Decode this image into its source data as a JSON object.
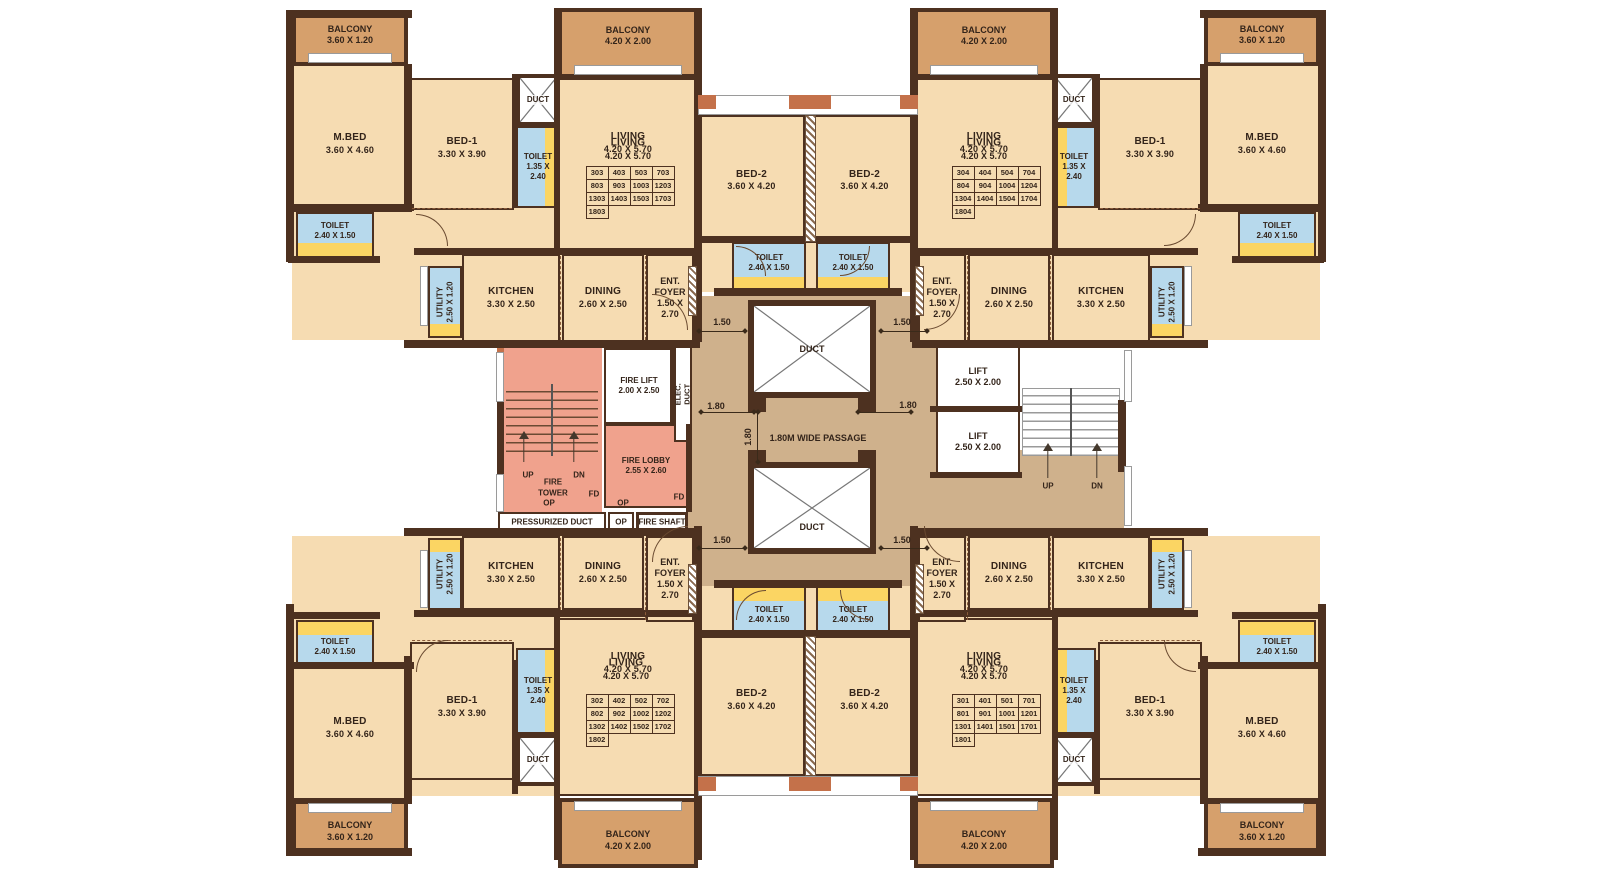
{
  "title": "Apartment typical floor plan",
  "colors": {
    "room_fill": "#f6dcb2",
    "balcony_fill": "#d6a06c",
    "wall": "#4d3120",
    "accent": "#c4714a",
    "toilet_blue": "#b7d9ec",
    "utility_yellow": "#fbd563",
    "fire_zone_pink": "#f0a28d",
    "passage_tan": "#cfb18c",
    "text": "#33241a"
  },
  "room_types": {
    "mbed": {
      "name": "M.BED",
      "dims": "3.60 X 4.60"
    },
    "bed1": {
      "name": "BED-1",
      "dims": "3.30 X 3.90"
    },
    "bed2": {
      "name": "BED-2",
      "dims": "3.60 X 4.20"
    },
    "living": {
      "name": "LIVING",
      "dims": "4.20 X 5.70"
    },
    "dining": {
      "name": "DINING",
      "dims": "2.60 X 2.50"
    },
    "kitchen": {
      "name": "KITCHEN",
      "dims": "3.30 X 2.50"
    },
    "balcony_mbed": {
      "name": "BALCONY",
      "dims": "3.60 X 1.20"
    },
    "balcony_living": {
      "name": "BALCONY",
      "dims": "4.20 X 2.00"
    },
    "toilet_240": {
      "name": "TOILET",
      "dims": "2.40 X 1.50"
    },
    "toilet_135": {
      "name": "TOILET",
      "dims": "1.35 X",
      "dims2": "2.40"
    },
    "utility": {
      "name": "UTILITY",
      "dims": "2.50 X 1.20"
    },
    "foyer": {
      "name": "ENT.",
      "name2": "FOYER",
      "dims": "1.50 X",
      "dims2": "2.70"
    },
    "duct": {
      "name": "DUCT"
    },
    "elec_duct": {
      "name": "ELEC. DUCT"
    },
    "fire_lift": {
      "name": "FIRE LIFT",
      "dims": "2.00 X 2.50"
    },
    "fire_lobby": {
      "name": "FIRE LOBBY",
      "dims": "2.55 X 2.60"
    },
    "fire_tower": {
      "name": "FIRE",
      "name2": "TOWER"
    },
    "lift": {
      "name": "LIFT",
      "dims": "2.50 X 2.00"
    }
  },
  "core_labels": {
    "up": "UP",
    "dn": "DN",
    "fd": "FD",
    "op": "OP",
    "pressurized_duct": "PRESSURIZED DUCT",
    "fire_shaft": "FIRE SHAFT",
    "passage": "1.80M WIDE PASSAGE"
  },
  "dimensions": {
    "d150": "1.50",
    "d180": "1.80"
  },
  "unit_numbers": {
    "top_left": [
      [
        "303",
        "403",
        "503",
        "703"
      ],
      [
        "803",
        "903",
        "1003",
        "1203"
      ],
      [
        "1303",
        "1403",
        "1503",
        "1703"
      ],
      [
        "1803"
      ]
    ],
    "top_right": [
      [
        "304",
        "404",
        "504",
        "704"
      ],
      [
        "804",
        "904",
        "1004",
        "1204"
      ],
      [
        "1304",
        "1404",
        "1504",
        "1704"
      ],
      [
        "1804"
      ]
    ],
    "bottom_left": [
      [
        "302",
        "402",
        "502",
        "702"
      ],
      [
        "802",
        "902",
        "1002",
        "1202"
      ],
      [
        "1302",
        "1402",
        "1502",
        "1702"
      ],
      [
        "1802"
      ]
    ],
    "bottom_right": [
      [
        "301",
        "401",
        "501",
        "701"
      ],
      [
        "801",
        "901",
        "1001",
        "1201"
      ],
      [
        "1301",
        "1401",
        "1501",
        "1701"
      ],
      [
        "1801"
      ]
    ]
  }
}
